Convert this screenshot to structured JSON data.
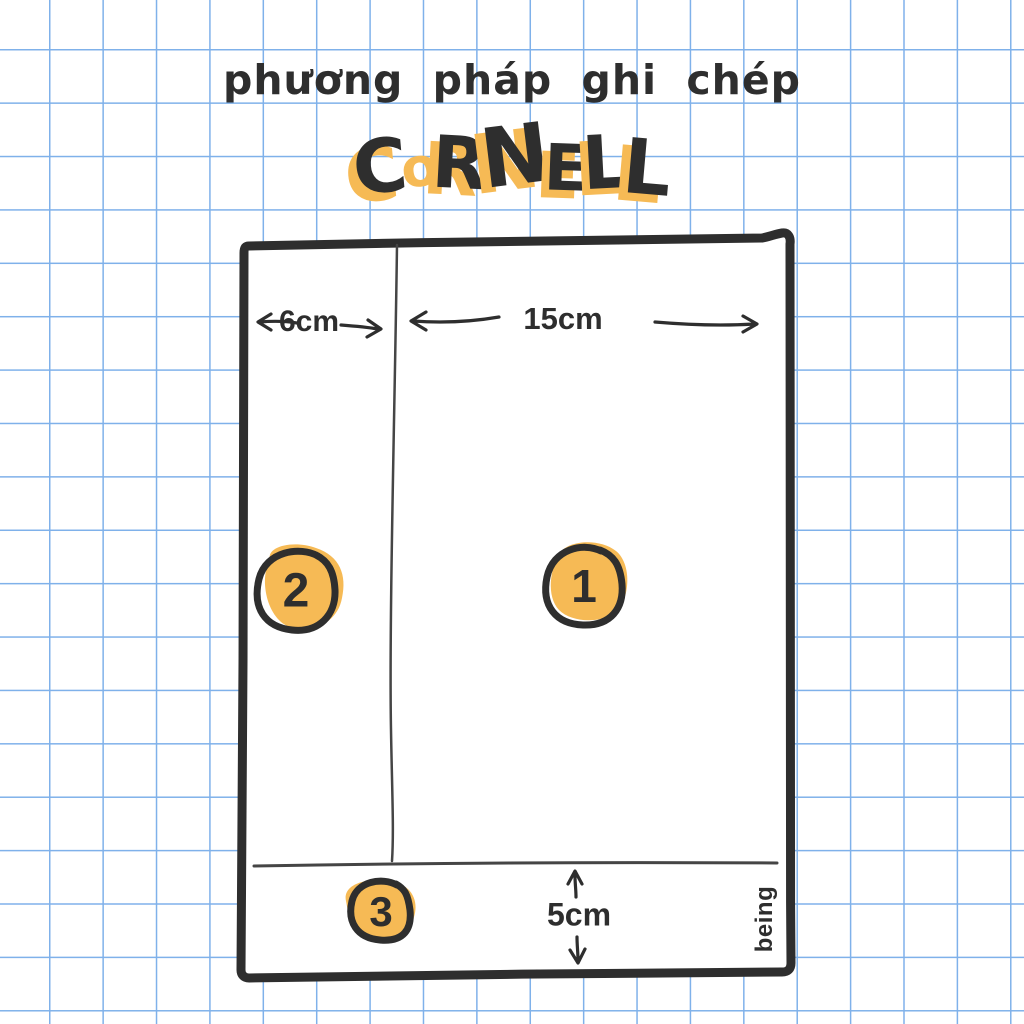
{
  "colors": {
    "ink": "#2e2e2e",
    "accent": "#f6ba55",
    "grid": "#7fb1ea",
    "line": "#454545",
    "paper": "#ffffff"
  },
  "title": {
    "subtitle": "phương pháp ghi chép",
    "word": "CORNELL",
    "letters": [
      {
        "ch": "C",
        "fill": "ink",
        "size": 74,
        "rot": -5,
        "dy": 6,
        "sx": -9,
        "sy": 8
      },
      {
        "ch": "o",
        "fill": "accent",
        "size": 54,
        "rot": -8,
        "dy": 0,
        "sx": 0,
        "sy": 0
      },
      {
        "ch": "R",
        "fill": "ink",
        "size": 72,
        "rot": 3,
        "dy": 2,
        "sx": -9,
        "sy": 7
      },
      {
        "ch": "N",
        "fill": "ink",
        "size": 82,
        "rot": -7,
        "dy": -2,
        "sx": -11,
        "sy": 5
      },
      {
        "ch": "E",
        "fill": "ink",
        "size": 64,
        "rot": 2,
        "dy": 4,
        "sx": -8,
        "sy": 8
      },
      {
        "ch": "L",
        "fill": "ink",
        "size": 74,
        "rot": -3,
        "dy": 2,
        "sx": -8,
        "sy": 6
      },
      {
        "ch": "L",
        "fill": "ink",
        "size": 76,
        "rot": 5,
        "dy": 8,
        "sx": -9,
        "sy": 8
      }
    ]
  },
  "diagram": {
    "cue_width": "6cm",
    "notes_width": "15cm",
    "summary_height": "5cm",
    "marker_notes": "1",
    "marker_cue": "2",
    "marker_summary": "3",
    "brand": "being"
  }
}
